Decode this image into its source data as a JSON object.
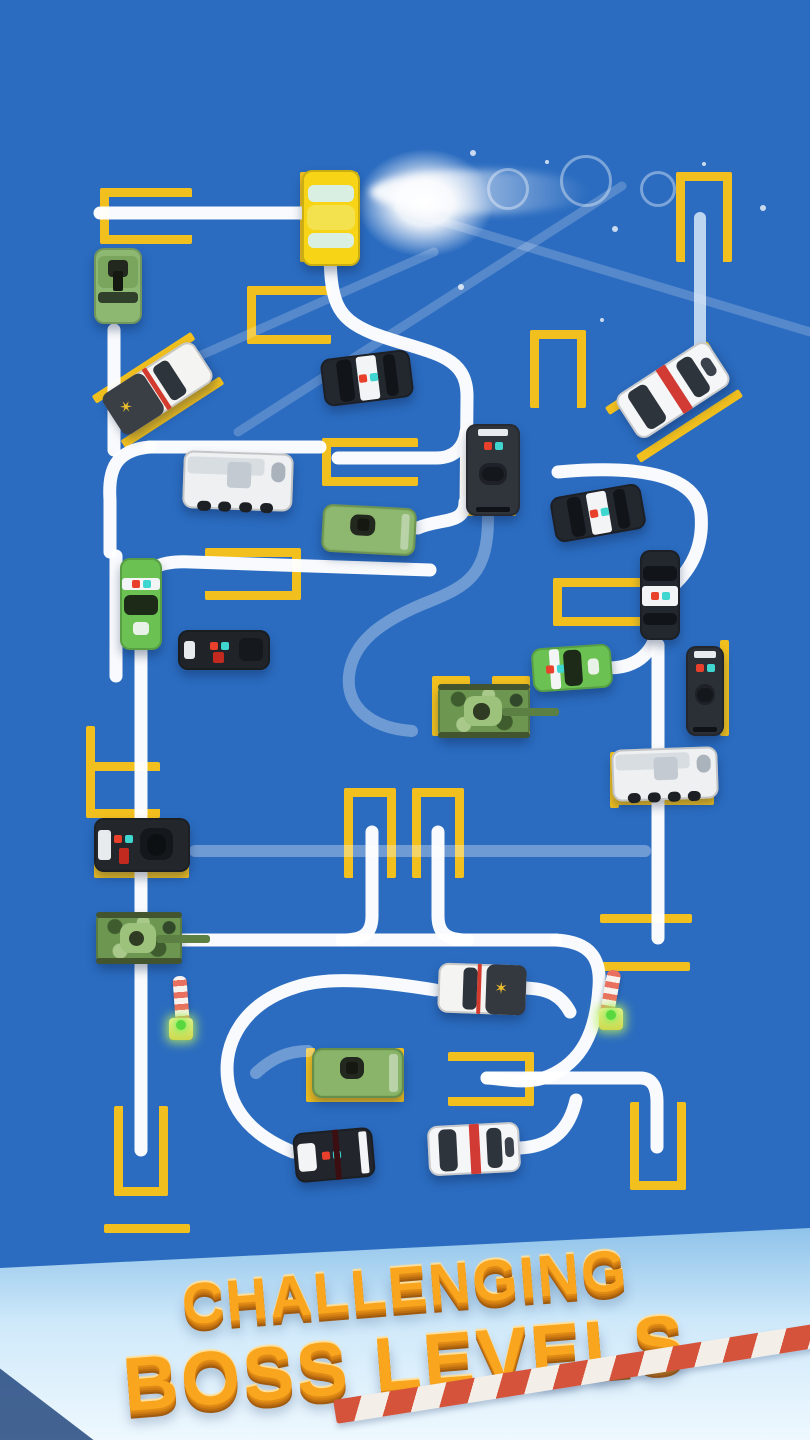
{
  "banner": {
    "line1": "CHALLENGING",
    "line2": "BOSS LEVELS",
    "text_color": "#f9a51d"
  },
  "board": {
    "background": "#2b6cc0",
    "marker_color": "#f1c01f",
    "path_color": "#ffffff",
    "banner_sky_top": "#8fc3ea",
    "banner_sky_bottom": "#eef8fe",
    "tape_red": "#d5533a"
  },
  "vehicles": [
    {
      "id": "yellow-car",
      "kind": "sedan",
      "x": 302,
      "y": 170,
      "w": 58,
      "h": 96,
      "rot": 0,
      "body": "#f7d516",
      "win": "#d9efe2"
    },
    {
      "id": "green-pickup",
      "kind": "military-pickup",
      "x": 94,
      "y": 248,
      "w": 48,
      "h": 76,
      "rot": 0,
      "body": "#8cb871"
    },
    {
      "id": "sheriff-truck-top",
      "kind": "sheriff-pickup",
      "x": 104,
      "y": 364,
      "w": 108,
      "h": 48,
      "rot": -33,
      "body": "#f4f5f3",
      "bed": "#3a3f46",
      "stripe": "#d33b2f",
      "bed_left": true
    },
    {
      "id": "police-muscle-top",
      "kind": "police-sedan",
      "x": 322,
      "y": 354,
      "w": 90,
      "h": 48,
      "rot": -7,
      "body": "#23272e"
    },
    {
      "id": "white-police-angled",
      "kind": "stripe-police",
      "x": 618,
      "y": 364,
      "w": 110,
      "h": 52,
      "rot": -33,
      "body": "#f4f6f8",
      "stripe": "#d23a34"
    },
    {
      "id": "swat-van",
      "kind": "swat-van",
      "x": 466,
      "y": 424,
      "w": 54,
      "h": 92,
      "rot": 0,
      "body": "#30343b"
    },
    {
      "id": "armored-truck-mid",
      "kind": "armored-truck",
      "x": 183,
      "y": 452,
      "w": 110,
      "h": 58,
      "rot": 2,
      "body": "#eef0f2"
    },
    {
      "id": "green-van",
      "kind": "military-van",
      "x": 322,
      "y": 506,
      "w": 94,
      "h": 48,
      "rot": 3,
      "body": "#85b264"
    },
    {
      "id": "police-muscle-right",
      "kind": "police-sedan",
      "x": 552,
      "y": 490,
      "w": 92,
      "h": 46,
      "rot": -10,
      "body": "#23272e"
    },
    {
      "id": "green-police-vert",
      "kind": "sports-police",
      "x": 120,
      "y": 558,
      "w": 42,
      "h": 92,
      "rot": 0,
      "body": "#6cc153"
    },
    {
      "id": "black-suv",
      "kind": "suv",
      "x": 178,
      "y": 630,
      "w": 92,
      "h": 40,
      "rot": 0,
      "body": "#202428"
    },
    {
      "id": "police-vert-right",
      "kind": "police-sedan",
      "x": 640,
      "y": 550,
      "w": 40,
      "h": 90,
      "rot": 0,
      "body": "#23272e"
    },
    {
      "id": "green-sports",
      "kind": "sports-police",
      "x": 532,
      "y": 646,
      "w": 80,
      "h": 44,
      "rot": -4,
      "body": "#6cc153"
    },
    {
      "id": "swat-suv-right",
      "kind": "swat-van",
      "x": 686,
      "y": 646,
      "w": 38,
      "h": 90,
      "rot": 0,
      "body": "#2b2f36"
    },
    {
      "id": "tank-mid",
      "kind": "tank",
      "x": 438,
      "y": 684,
      "w": 92,
      "h": 54,
      "rot": 0,
      "body": "#6d9750"
    },
    {
      "id": "armored-truck-right",
      "kind": "armored-truck",
      "x": 612,
      "y": 748,
      "w": 106,
      "h": 52,
      "rot": -2,
      "body": "#eef0f2"
    },
    {
      "id": "swat-truck-left",
      "kind": "swat-truck",
      "x": 94,
      "y": 818,
      "w": 96,
      "h": 54,
      "rot": 0,
      "body": "#23272b"
    },
    {
      "id": "tank-left",
      "kind": "tank",
      "x": 96,
      "y": 912,
      "w": 86,
      "h": 52,
      "rot": 0,
      "body": "#6d9750"
    },
    {
      "id": "sheriff-truck-bottom",
      "kind": "sheriff-pickup",
      "x": 438,
      "y": 964,
      "w": 88,
      "h": 50,
      "rot": 2,
      "body": "#f4f5f3",
      "bed": "#343940",
      "stripe": "#d33b2f",
      "bed_left": false
    },
    {
      "id": "green-truck-bottom",
      "kind": "military-van",
      "x": 312,
      "y": 1048,
      "w": 92,
      "h": 50,
      "rot": 0,
      "body": "#7fae5e"
    },
    {
      "id": "black-race",
      "kind": "race-police",
      "x": 294,
      "y": 1130,
      "w": 80,
      "h": 50,
      "rot": -5,
      "body": "#22262c"
    },
    {
      "id": "white-race",
      "kind": "race-stripe",
      "x": 428,
      "y": 1124,
      "w": 92,
      "h": 50,
      "rot": -3,
      "body": "#f4f6f8",
      "stripe": "#d23a34"
    }
  ],
  "markers": [
    {
      "x": 100,
      "y": 188,
      "w": 92,
      "h": 56,
      "sides": "ltb"
    },
    {
      "x": 300,
      "y": 172,
      "w": 58,
      "h": 90,
      "sides": "ltr"
    },
    {
      "x": 247,
      "y": 286,
      "w": 84,
      "h": 58,
      "sides": "ltb"
    },
    {
      "x": 676,
      "y": 172,
      "w": 56,
      "h": 90,
      "sides": "ltr"
    },
    {
      "type": "diag",
      "cx": 158,
      "cy": 390,
      "len": 118,
      "rot": -33,
      "gap": 62
    },
    {
      "x": 322,
      "y": 438,
      "w": 96,
      "h": 48,
      "sides": "ltb"
    },
    {
      "x": 460,
      "y": 428,
      "w": 56,
      "h": 88,
      "sides": "lrb"
    },
    {
      "x": 530,
      "y": 330,
      "w": 56,
      "h": 78,
      "sides": "ltr"
    },
    {
      "type": "diag",
      "cx": 674,
      "cy": 402,
      "len": 122,
      "rot": -33,
      "gap": 66
    },
    {
      "x": 205,
      "y": 548,
      "w": 96,
      "h": 52,
      "sides": "trb"
    },
    {
      "x": 553,
      "y": 578,
      "w": 88,
      "h": 48,
      "sides": "ltb"
    },
    {
      "x": 432,
      "y": 676,
      "w": 38,
      "h": 60,
      "sides": "lt"
    },
    {
      "x": 492,
      "y": 676,
      "w": 38,
      "h": 60,
      "sides": "tr"
    },
    {
      "x": 720,
      "y": 640,
      "w": 9,
      "h": 96,
      "sides": "l"
    },
    {
      "x": 610,
      "y": 752,
      "w": 9,
      "h": 56,
      "sides": "l"
    },
    {
      "x": 610,
      "y": 796,
      "w": 104,
      "h": 9,
      "sides": "t"
    },
    {
      "x": 600,
      "y": 914,
      "w": 92,
      "h": 9,
      "sides": "t"
    },
    {
      "x": 600,
      "y": 962,
      "w": 90,
      "h": 9,
      "sides": "t"
    },
    {
      "x": 86,
      "y": 726,
      "w": 9,
      "h": 44,
      "sides": "l"
    },
    {
      "x": 86,
      "y": 762,
      "w": 74,
      "h": 56,
      "sides": "ltb"
    },
    {
      "x": 94,
      "y": 826,
      "w": 95,
      "h": 52,
      "sides": "lrb"
    },
    {
      "x": 114,
      "y": 1106,
      "w": 54,
      "h": 90,
      "sides": "lrb"
    },
    {
      "x": 344,
      "y": 788,
      "w": 52,
      "h": 90,
      "sides": "ltr"
    },
    {
      "x": 412,
      "y": 788,
      "w": 52,
      "h": 90,
      "sides": "ltr"
    },
    {
      "x": 306,
      "y": 1048,
      "w": 98,
      "h": 54,
      "sides": "lrb"
    },
    {
      "x": 448,
      "y": 1052,
      "w": 86,
      "h": 54,
      "sides": "trb"
    },
    {
      "x": 630,
      "y": 1102,
      "w": 56,
      "h": 88,
      "sides": "lrb"
    },
    {
      "x": 104,
      "y": 1224,
      "w": 86,
      "h": 9,
      "sides": "t"
    }
  ],
  "paths": {
    "solid": [
      "M100 213 H312",
      "M330 245 C330 300 335 318 372 333 C428 354 468 352 467 398 L466 505",
      "M338 458 H436 C456 458 464 446 466 432",
      "M150 447 H320",
      "M150 447 C115 450 108 470 110 500 L110 552",
      "M116 556 V676",
      "M114 330 V450",
      "M141 648 V1150",
      "M140 602 C140 572 152 560 192 562 L430 570",
      "M465 502 C465 525 440 518 418 528",
      "M558 472 C625 466 696 470 701 514 C704 548 690 572 668 590",
      "M608 668 C636 668 650 654 656 636",
      "M658 645 V938",
      "M145 940 H556",
      "M556 940 C592 942 601 960 599 987 C596 1034 581 1062 549 1076 C528 1085 505 1079 487 1078",
      "M487 1078 H640 C653 1078 657 1088 657 1102 V1147",
      "M435 990 C385 982 330 975 296 987 C244 1003 222 1042 228 1082 C233 1114 256 1137 293 1152",
      "M522 988 C550 988 562 997 570 1012",
      "M520 1148 C556 1146 570 1126 576 1100",
      "M372 832 V916 C372 936 360 940 342 940",
      "M438 832 V916 C438 936 450 940 468 940"
    ],
    "light": [
      "M700 218 V358"
    ],
    "faded": [
      "M195 851 H645",
      "M488 518 C488 574 468 586 428 602 C378 622 352 644 349 676 C346 708 372 728 412 731",
      "M256 1073 C272 1058 288 1051 308 1051"
    ],
    "beams": [
      "M398 208 L810 332",
      "M622 186 L238 432",
      "M118 392 L434 252"
    ]
  },
  "poles": [
    {
      "x": 174,
      "y": 976,
      "h": 46,
      "lean": -4
    },
    {
      "x": 604,
      "y": 970,
      "h": 42,
      "lean": 10
    }
  ],
  "effects": {
    "glow": {
      "x": 330,
      "y": 128,
      "w": 190,
      "h": 150
    },
    "streak": {
      "x": 370,
      "y": 170,
      "w": 220,
      "h": 44
    },
    "rings": [
      {
        "x": 505,
        "y": 186,
        "r": 18
      },
      {
        "x": 583,
        "y": 178,
        "r": 23
      },
      {
        "x": 655,
        "y": 186,
        "r": 15
      }
    ],
    "dots": [
      {
        "x": 470,
        "y": 150,
        "r": 3
      },
      {
        "x": 545,
        "y": 160,
        "r": 2
      },
      {
        "x": 612,
        "y": 226,
        "r": 3
      },
      {
        "x": 702,
        "y": 162,
        "r": 2
      },
      {
        "x": 760,
        "y": 205,
        "r": 3
      },
      {
        "x": 458,
        "y": 284,
        "r": 3
      },
      {
        "x": 600,
        "y": 318,
        "r": 2
      }
    ],
    "sparkle": {
      "x": 585,
      "y": 1284,
      "glyph": "✦",
      "size": 30
    }
  }
}
